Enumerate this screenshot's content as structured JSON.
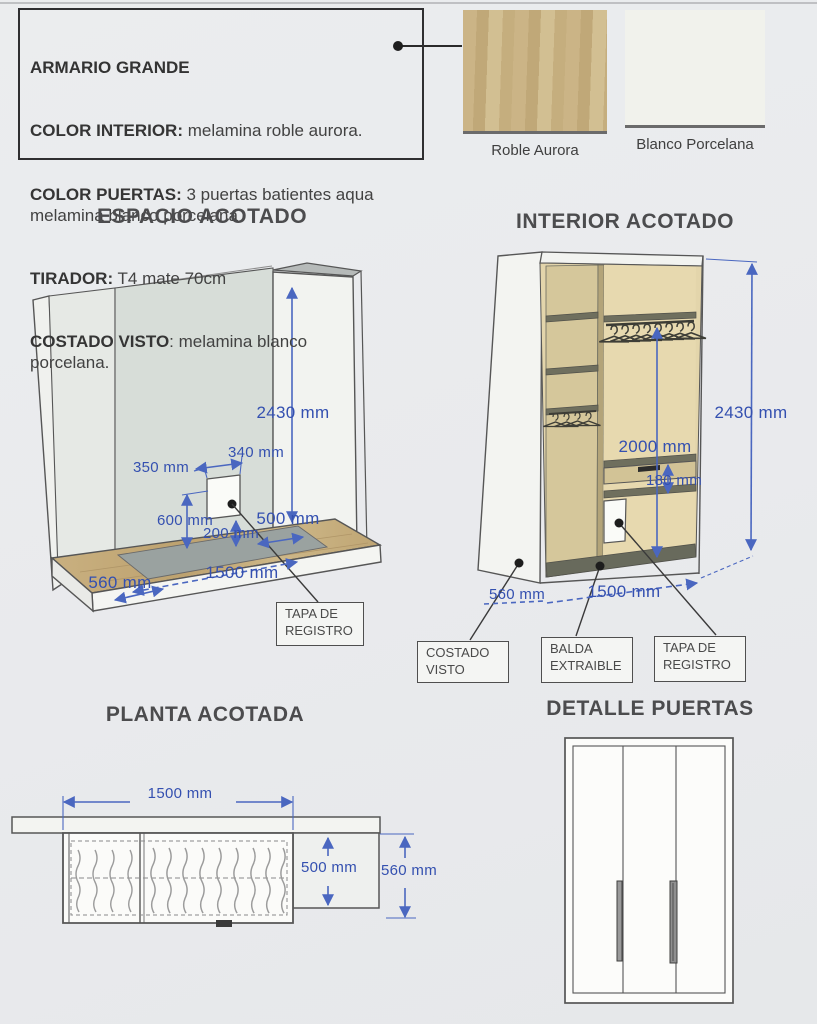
{
  "spec_box": {
    "title": "ARMARIO GRANDE",
    "items": [
      {
        "label": "COLOR INTERIOR:",
        "text": " melamina roble aurora."
      },
      {
        "label": "COLOR PUERTAS:",
        "text": " 3 puertas batientes aqua\nmelamina blanco porcelana"
      },
      {
        "label": "TIRADOR:",
        "text": " T4 mate 70cm"
      },
      {
        "label": "COSTADO VISTO",
        "text": ": melamina blanco\nporcelana."
      }
    ]
  },
  "swatches": {
    "roble": {
      "label": "Roble Aurora",
      "color": "#c6b082"
    },
    "blanco": {
      "label": "Blanco Porcelana",
      "color": "#f1f2ec"
    }
  },
  "espacio": {
    "title": "ESPACIO ACOTADO",
    "dims": {
      "height": "2430 mm",
      "hatch_width": "340 mm",
      "hatch_offset": "350 mm",
      "hatch_bottom": "600 mm",
      "hatch_rise": "200 mm",
      "depth_inner": "500 mm",
      "width": "1500 mm",
      "depth": "560 mm"
    },
    "callouts": {
      "tapa": "TAPA DE REGISTRO"
    }
  },
  "interior": {
    "title": "INTERIOR ACOTADO",
    "dims": {
      "height": "2430 mm",
      "rail_height": "2000 mm",
      "drawer_gap": "180 mm",
      "depth": "560 mm",
      "width": "1500 mm"
    },
    "callouts": {
      "costado": "COSTADO VISTO",
      "balda": "BALDA EXTRAIBLE",
      "tapa": "TAPA DE REGISTRO"
    }
  },
  "planta": {
    "title": "PLANTA ACOTADA",
    "dims": {
      "width": "1500 mm",
      "depth_inner": "500 mm",
      "depth_total": "560 mm"
    }
  },
  "puertas": {
    "title": "DETALLE PUERTAS"
  }
}
